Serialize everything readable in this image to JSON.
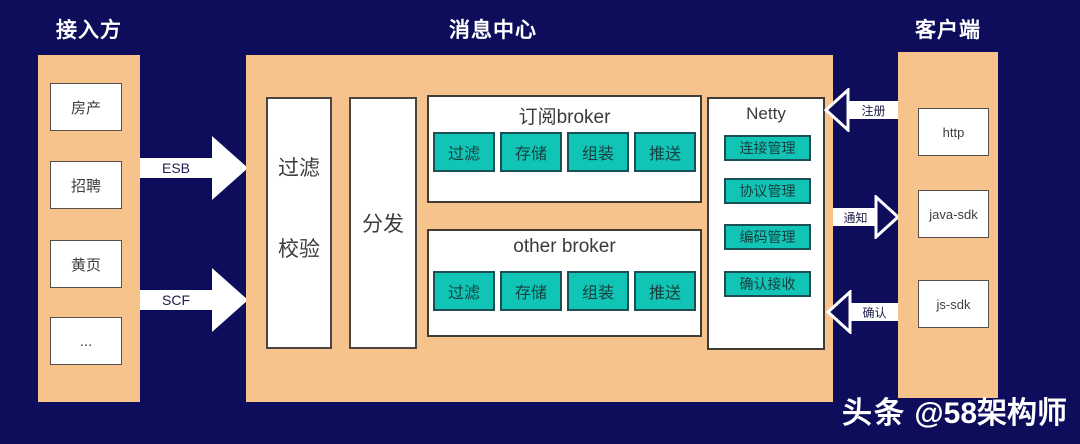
{
  "colors": {
    "background": "#0d0d5b",
    "panel_orange": "#f7c38d",
    "box_teal": "#10c5b5",
    "arrow_white": "#ffffff"
  },
  "access": {
    "title": "接入方",
    "items": [
      "房产",
      "招聘",
      "黄页",
      "..."
    ]
  },
  "center": {
    "title": "消息中心",
    "filter": [
      "过滤",
      "校验"
    ],
    "dispatch": "分发",
    "brokers": [
      {
        "title": "订阅broker",
        "steps": [
          "过滤",
          "存储",
          "组装",
          "推送"
        ]
      },
      {
        "title": "other broker",
        "steps": [
          "过滤",
          "存储",
          "组装",
          "推送"
        ]
      }
    ],
    "netty": {
      "title": "Netty",
      "items": [
        "连接管理",
        "协议管理",
        "编码管理",
        "确认接收"
      ]
    }
  },
  "client": {
    "title": "客户端",
    "items": [
      "http",
      "java-sdk",
      "js-sdk"
    ]
  },
  "arrows": {
    "esb": "ESB",
    "scf": "SCF",
    "register": "注册",
    "notify": "通知",
    "ack": "确认"
  },
  "watermark": {
    "brand": "头条",
    "handle": "@58架构师"
  }
}
